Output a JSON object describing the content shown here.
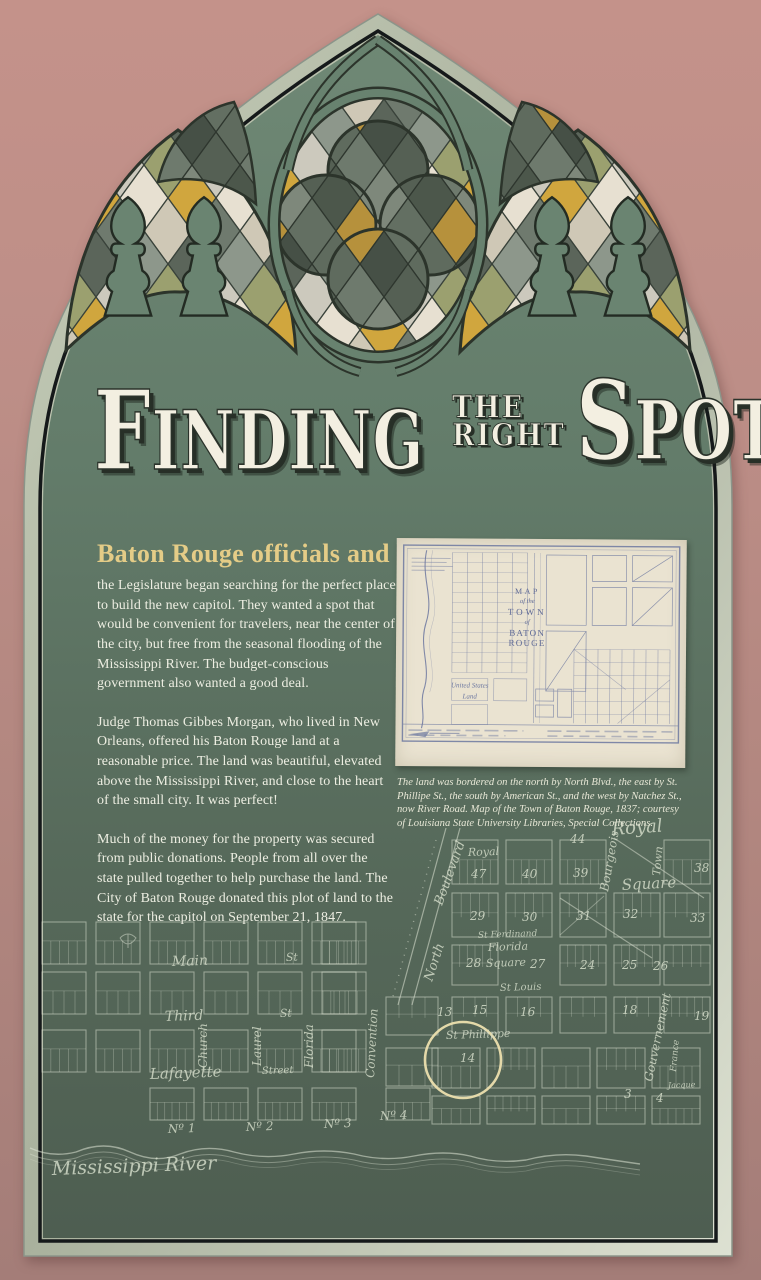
{
  "panel": {
    "colors": {
      "wall": "#bd8e87",
      "panel_green_top": "#6f8875",
      "panel_green_bottom": "#4e5e51",
      "border_band": "#b9c2ae",
      "accent_gold": "#e4cc87",
      "text_cream": "#edeee2",
      "glass_gold": "#d0a63e",
      "highlight_circle": "#ecdfae"
    }
  },
  "title": {
    "finding": "FINDING",
    "the": "THE",
    "right": "RIGHT",
    "spot": "SPOT"
  },
  "article": {
    "lead": "Baton Rouge officials and",
    "paragraph1": "the Legislature began searching for the perfect place to build the new capitol. They wanted a spot that would be convenient for travelers, near the center of the city, but free from the seasonal flooding of the Mississippi River. The budget-conscious government also wanted a good deal.",
    "paragraph2": "Judge Thomas Gibbes Morgan, who lived in New Orleans, offered his Baton Rouge land at a reasonable price. The land was beautiful, elevated above the Mississippi River, and close to the heart of the small city. It was perfect!",
    "paragraph3": "Much of the money for the property was secured from public donations. People from all over the state pulled together to help purchase the land. The City of Baton Rouge donated this plot of land to the state for the capitol on September 21, 1847."
  },
  "inset_map": {
    "title_lines": [
      "MAP",
      "of the",
      "TOWN",
      "of",
      "BATON ROUGE"
    ],
    "land_label": "United States Land",
    "caption": "The land was bordered on the north by North Blvd., the east by St. Phillipe St., the south by American St., and the west by Natchez St., now River Road. Map of the Town of Baton Rouge, 1837; courtesy of Louisiana State University Libraries, Special Collections."
  },
  "background_map": {
    "labels": [
      {
        "text": "Main",
        "x": 172,
        "y": 966,
        "r": -2,
        "size": 14
      },
      {
        "text": "St",
        "x": 286,
        "y": 961,
        "r": -2,
        "size": 11
      },
      {
        "text": "Third",
        "x": 165,
        "y": 1021,
        "r": -2,
        "size": 14
      },
      {
        "text": "St",
        "x": 280,
        "y": 1017,
        "r": -2,
        "size": 11
      },
      {
        "text": "Lafayette",
        "x": 150,
        "y": 1079,
        "r": -2,
        "size": 15
      },
      {
        "text": "Street",
        "x": 262,
        "y": 1074,
        "r": -2,
        "size": 10
      },
      {
        "text": "Church",
        "x": 207,
        "y": 1068,
        "r": -90,
        "size": 12
      },
      {
        "text": "Laurel",
        "x": 261,
        "y": 1066,
        "r": -90,
        "size": 12
      },
      {
        "text": "Florida",
        "x": 313,
        "y": 1068,
        "r": -90,
        "size": 12
      },
      {
        "text": "Convention",
        "x": 374,
        "y": 1078,
        "r": -87,
        "size": 12
      },
      {
        "text": "North",
        "x": 432,
        "y": 982,
        "r": -72,
        "size": 13
      },
      {
        "text": "Boulevard",
        "x": 442,
        "y": 906,
        "r": -70,
        "size": 13
      },
      {
        "text": "Royal",
        "x": 468,
        "y": 856,
        "r": -2,
        "size": 11
      },
      {
        "text": "Royal",
        "x": 612,
        "y": 835,
        "r": -4,
        "size": 18
      },
      {
        "text": "Square",
        "x": 622,
        "y": 890,
        "r": -3,
        "size": 15
      },
      {
        "text": "Town",
        "x": 660,
        "y": 876,
        "r": -85,
        "size": 11
      },
      {
        "text": "Bourgeois",
        "x": 608,
        "y": 892,
        "r": -80,
        "size": 12
      },
      {
        "text": "St Ferdinand",
        "x": 478,
        "y": 938,
        "r": -2,
        "size": 9
      },
      {
        "text": "Florida",
        "x": 488,
        "y": 951,
        "r": -2,
        "size": 11
      },
      {
        "text": "Square",
        "x": 486,
        "y": 967,
        "r": -2,
        "size": 11
      },
      {
        "text": "St Louis",
        "x": 500,
        "y": 991,
        "r": -2,
        "size": 10
      },
      {
        "text": "St Phillippe",
        "x": 446,
        "y": 1039,
        "r": -2,
        "size": 11
      },
      {
        "text": "Gouvernement",
        "x": 652,
        "y": 1082,
        "r": -78,
        "size": 12
      },
      {
        "text": "France",
        "x": 676,
        "y": 1072,
        "r": -85,
        "size": 9
      },
      {
        "text": "Jacque",
        "x": 668,
        "y": 1088,
        "r": -2,
        "size": 8
      },
      {
        "text": "Nº 1",
        "x": 168,
        "y": 1133,
        "r": -2,
        "size": 12
      },
      {
        "text": "Nº 2",
        "x": 246,
        "y": 1131,
        "r": -2,
        "size": 12
      },
      {
        "text": "Nº 3",
        "x": 324,
        "y": 1128,
        "r": -2,
        "size": 12
      },
      {
        "text": "Nº 4",
        "x": 380,
        "y": 1120,
        "r": -2,
        "size": 12
      },
      {
        "text": "Mississippi River",
        "x": 52,
        "y": 1175,
        "r": -2,
        "size": 19
      }
    ],
    "block_numbers": [
      {
        "n": "13",
        "x": 437,
        "y": 1016
      },
      {
        "n": "14",
        "x": 460,
        "y": 1062
      },
      {
        "n": "15",
        "x": 472,
        "y": 1014
      },
      {
        "n": "16",
        "x": 520,
        "y": 1016
      },
      {
        "n": "18",
        "x": 622,
        "y": 1014
      },
      {
        "n": "19",
        "x": 694,
        "y": 1020
      },
      {
        "n": "24",
        "x": 580,
        "y": 969
      },
      {
        "n": "25",
        "x": 622,
        "y": 969
      },
      {
        "n": "26",
        "x": 653,
        "y": 970
      },
      {
        "n": "27",
        "x": 530,
        "y": 968
      },
      {
        "n": "28",
        "x": 466,
        "y": 967
      },
      {
        "n": "29",
        "x": 470,
        "y": 920
      },
      {
        "n": "30",
        "x": 522,
        "y": 921
      },
      {
        "n": "31",
        "x": 576,
        "y": 920
      },
      {
        "n": "32",
        "x": 623,
        "y": 918
      },
      {
        "n": "33",
        "x": 690,
        "y": 922
      },
      {
        "n": "38",
        "x": 694,
        "y": 872
      },
      {
        "n": "39",
        "x": 573,
        "y": 877
      },
      {
        "n": "40",
        "x": 522,
        "y": 878
      },
      {
        "n": "44",
        "x": 570,
        "y": 843
      },
      {
        "n": "47",
        "x": 471,
        "y": 878
      },
      {
        "n": "3",
        "x": 624,
        "y": 1098
      },
      {
        "n": "4",
        "x": 656,
        "y": 1102
      }
    ]
  }
}
